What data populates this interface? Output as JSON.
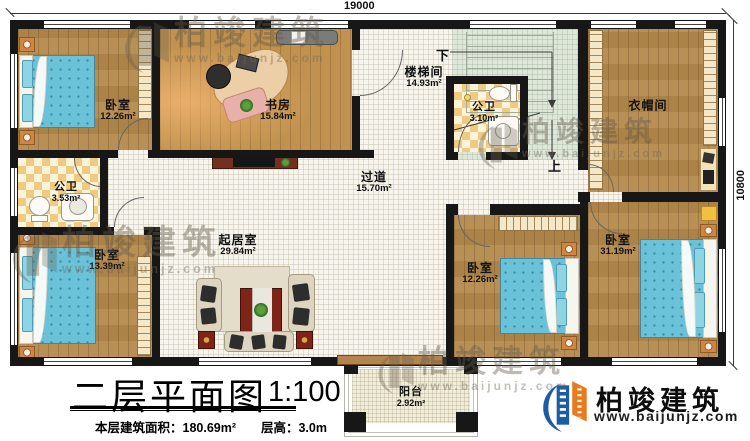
{
  "drawing": {
    "dim_top": "19000",
    "dim_right": "10800"
  },
  "rooms": {
    "bedroom_tl": {
      "label": "卧室",
      "area": "12.26m²"
    },
    "study": {
      "label": "书房",
      "area": "15.84m²"
    },
    "bath_upper": {
      "label": "公卫",
      "area": "3.53m²"
    },
    "stairwell": {
      "label": "楼梯间",
      "area": "14.93m²"
    },
    "bath_stair": {
      "label": "公卫",
      "area": "3.10m²"
    },
    "cloakroom": {
      "label": "衣帽间"
    },
    "corridor": {
      "label": "过道",
      "area": "15.70m²"
    },
    "bedroom_bl": {
      "label": "卧室",
      "area": "13.39m²"
    },
    "living": {
      "label": "起居室",
      "area": "29.84m²"
    },
    "bedroom_bm": {
      "label": "卧室",
      "area": "12.26m²"
    },
    "bedroom_br": {
      "label": "卧室",
      "area": "31.19m²"
    },
    "balcony": {
      "label": "阳台",
      "area": "2.92m²"
    }
  },
  "stairs": {
    "down": "下",
    "up": "上"
  },
  "title_block": {
    "title": "二层平面图",
    "scale": "1:100",
    "area_text": "本层建筑面积：180.69m²",
    "height_text": "层高：3.0m"
  },
  "branding": {
    "name": "柏竣建筑",
    "website": "www.baijunjz.com",
    "blue": "#1c5ba6",
    "orange": "#ea7b1d"
  },
  "watermark": {
    "name": "柏竣建筑",
    "website": "www.baijunjz.com"
  }
}
